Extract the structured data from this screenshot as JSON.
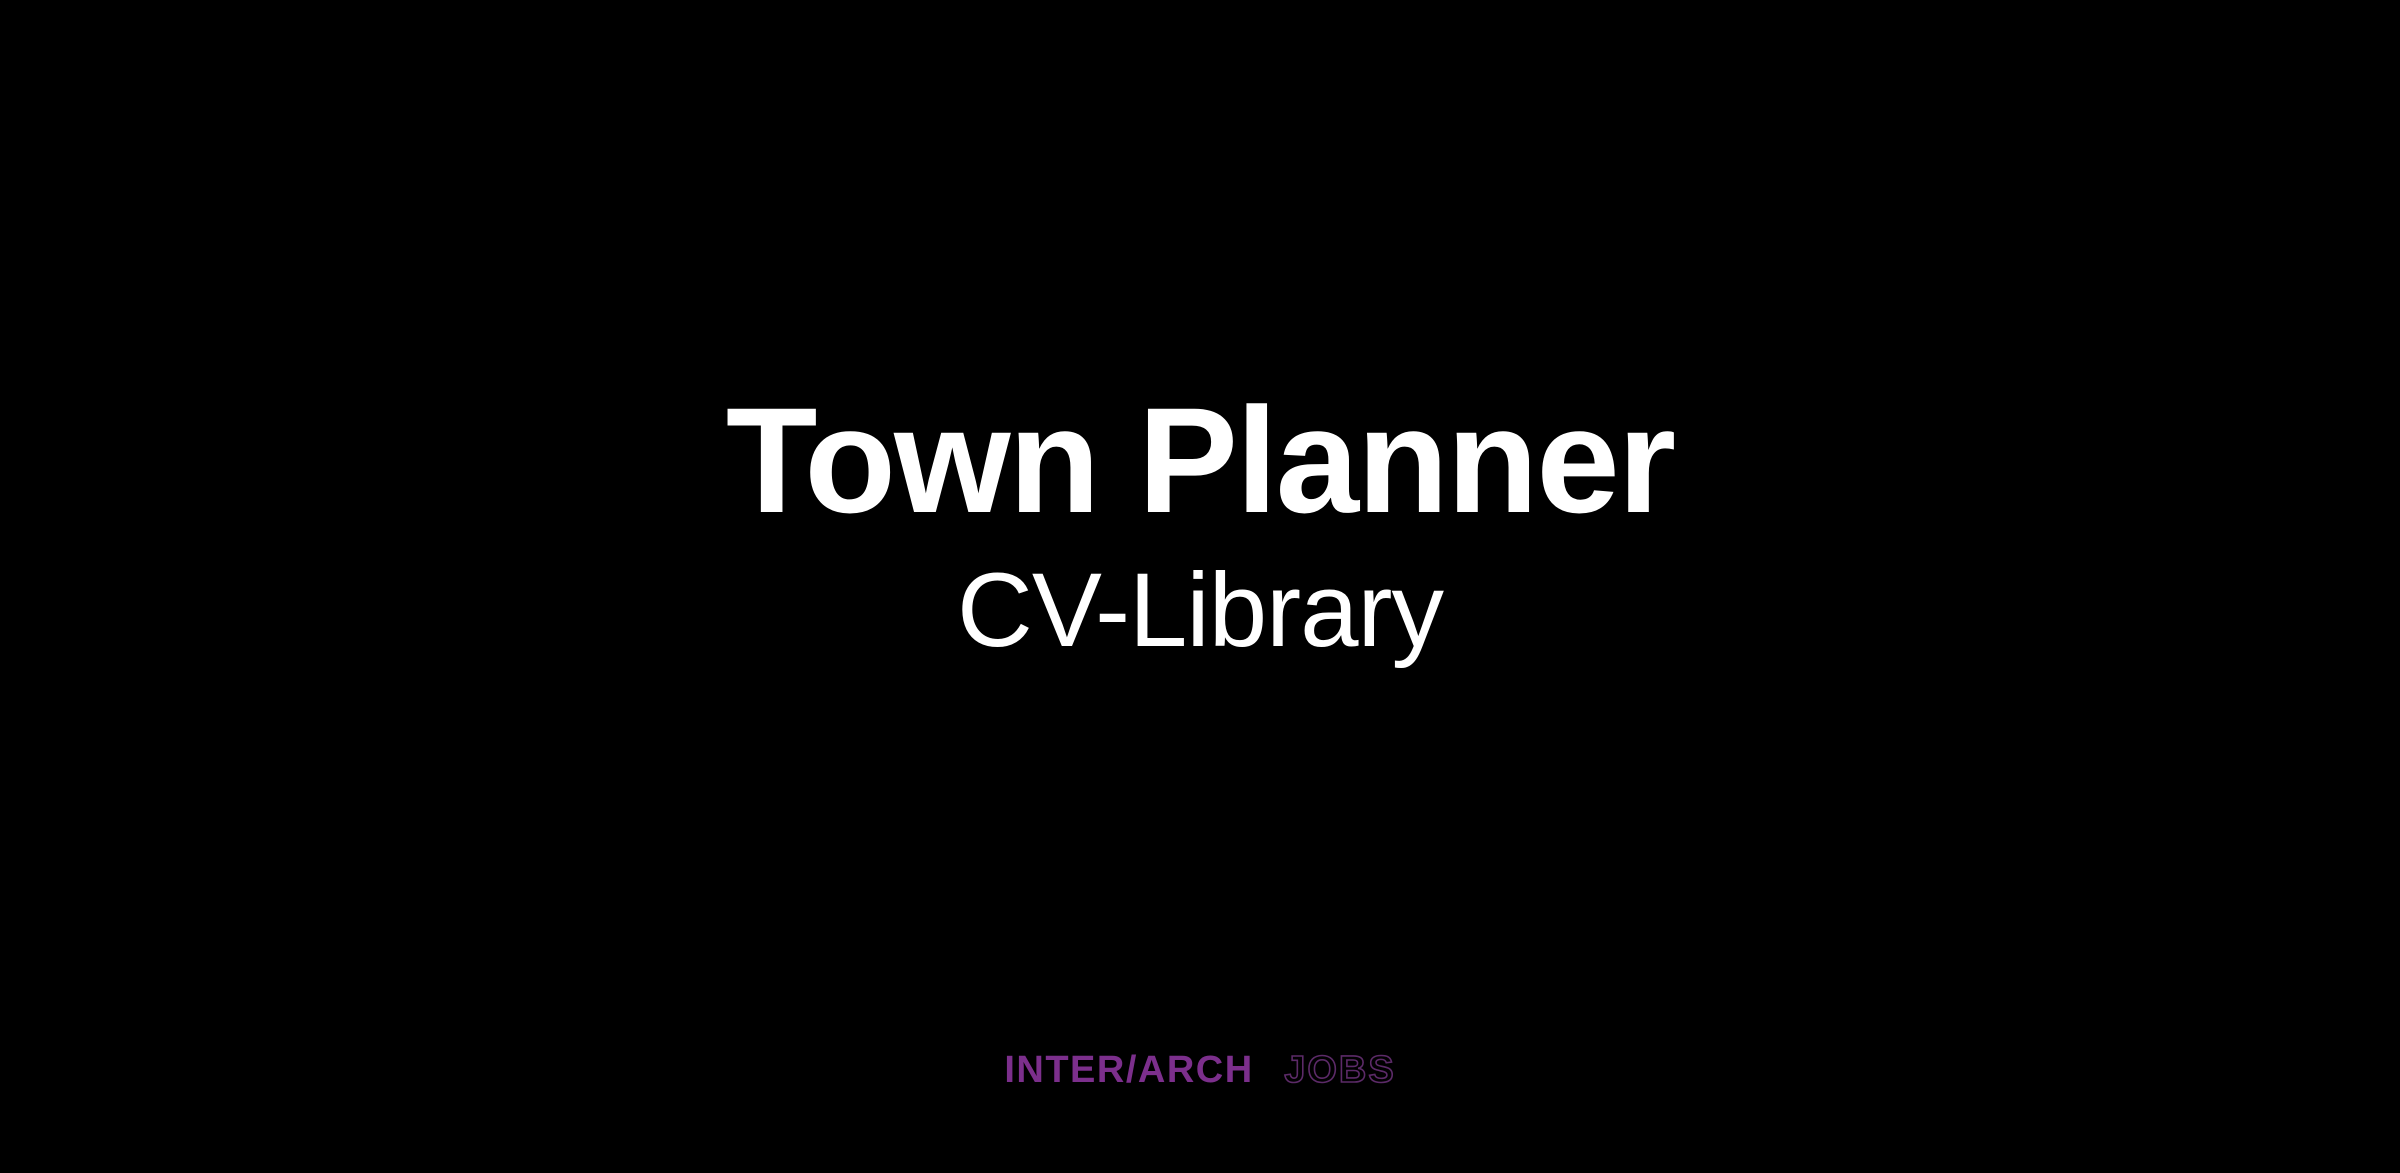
{
  "colors": {
    "background": "#000000",
    "text": "#ffffff",
    "logo_primary": "#7c2f8c",
    "logo_outline": "#5c2a68"
  },
  "hero": {
    "job_title": "Town Planner",
    "company": "CV-Library"
  },
  "footer_logo": {
    "brand_primary": "INTER/ARCH",
    "brand_secondary": "JOBS"
  }
}
